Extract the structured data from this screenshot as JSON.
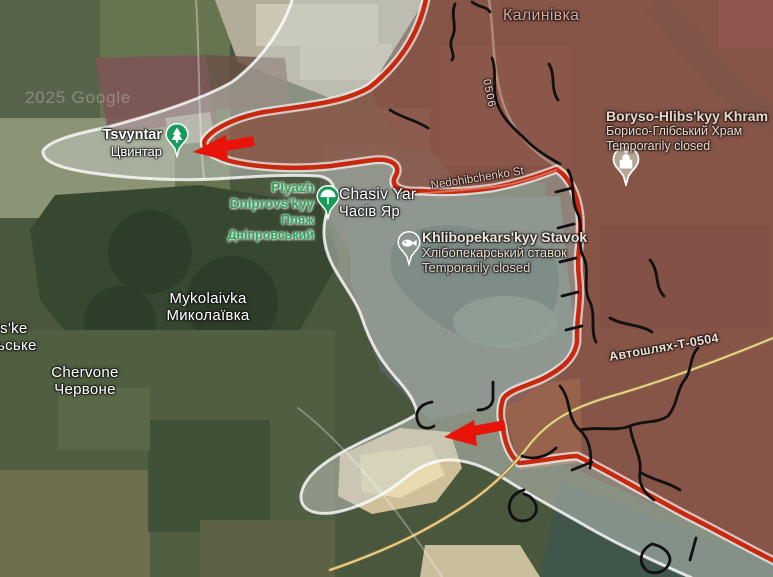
{
  "map_type": "satellite",
  "watermark": "2025 Google",
  "labels": {
    "kalynivka": {
      "uk": "Калинівка"
    },
    "khram": {
      "en": "Boryso-Hlibs'kyy Khram",
      "uk": "Борисо-Глібський Храм",
      "status": "Temporarily closed"
    },
    "tsvyntar": {
      "en": "Tsvyntar",
      "uk": "Цвинтар"
    },
    "plyazh": {
      "en1": "Plyazh",
      "en2": "Dniprovs'kyy",
      "uk1": "Пляж",
      "uk2": "Дніпровський"
    },
    "chasiv_yar": {
      "en": "Chasiv Yar",
      "uk": "Часів Яр"
    },
    "stavok": {
      "en": "Khlibopekars'kyy Stavok",
      "uk": "Хлібопекарський ставок",
      "status": "Temporarily closed"
    },
    "mykolaivka": {
      "en": "Mykolaivka",
      "uk": "Миколаївка"
    },
    "ske_partial": {
      "en": "'s'ke",
      "uk": "ьське"
    },
    "chervone": {
      "en": "Chervone",
      "uk": "Червоне"
    },
    "roads": {
      "t0504": "Автошлях-Т-0504",
      "c0506": "0506",
      "nedohibchenko": "Nedohibchenko St"
    }
  },
  "pins": {
    "tsvyntar": {
      "type": "cemetery",
      "color": "#169c5a"
    },
    "plyazh": {
      "type": "beach",
      "color": "#169c5a"
    },
    "stavok": {
      "type": "fishing-pond",
      "color": "#8d9591"
    },
    "khram": {
      "type": "church",
      "color": "#b5a795"
    }
  },
  "military_overlay": {
    "frontline_color": "#c9280e",
    "gray_zone_color": "#cfd2cf",
    "arrow_color": "#e81309",
    "trench_color": "#111111",
    "arrows": [
      {
        "id": "arrow-west",
        "direction": "left"
      },
      {
        "id": "arrow-south",
        "direction": "left"
      }
    ]
  }
}
